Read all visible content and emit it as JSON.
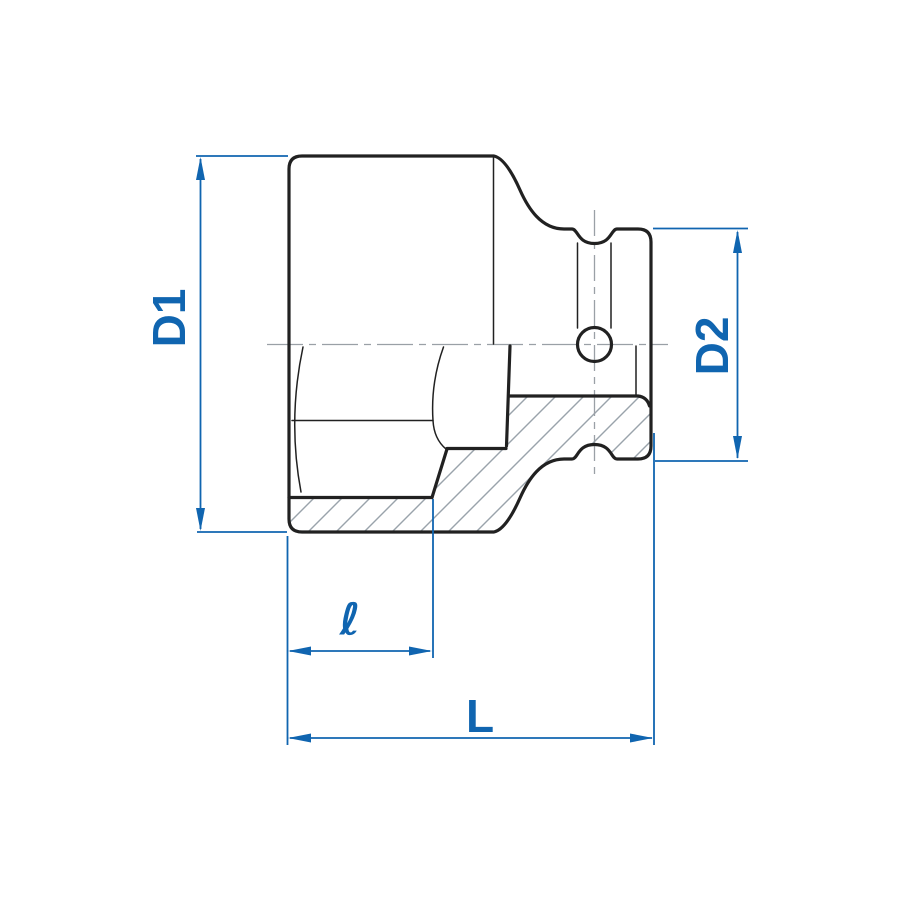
{
  "labels": {
    "d1": "D1",
    "d2": "D2",
    "hex_depth": "ℓ",
    "total_length": "L"
  },
  "colors": {
    "dimension_blue": "#1065b0",
    "outline_dark": "#212121",
    "hatch_gray": "#9aa3ab",
    "centerline_gray": "#9aa0a6",
    "background": "#ffffff"
  }
}
